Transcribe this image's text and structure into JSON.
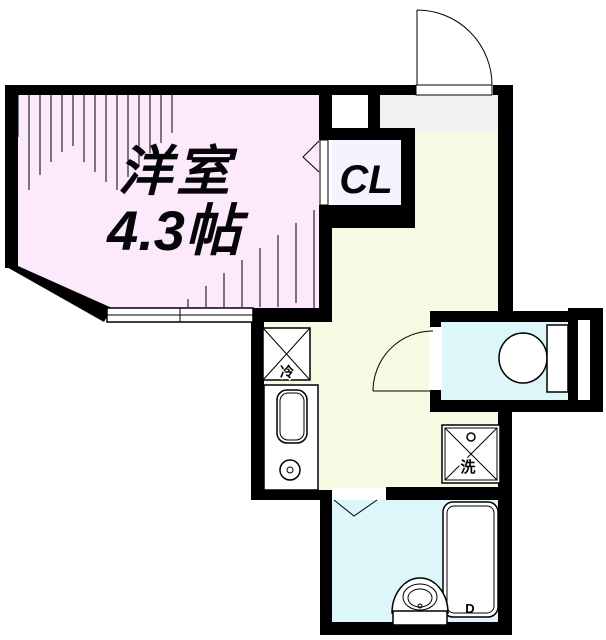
{
  "plan": {
    "type": "floor-plan",
    "rooms": {
      "western_room": {
        "name": "洋室",
        "size": "4.3帖",
        "color": "#fce9fb"
      },
      "kitchen": {
        "color": "#f8f9e2"
      },
      "closet": {
        "label": "CL",
        "color": "#f3f4fd"
      },
      "entry": {
        "color": "#f1f1f1"
      },
      "toilet": {
        "color": "#dcf6f9"
      },
      "bathroom": {
        "color": "#dcf6f9"
      }
    },
    "fixtures": {
      "refrigerator_label": "冷",
      "laundry_label": "洗",
      "bathtub_label": "D"
    },
    "wall_color": "#000000",
    "fixture_fill": "#ffffff"
  }
}
